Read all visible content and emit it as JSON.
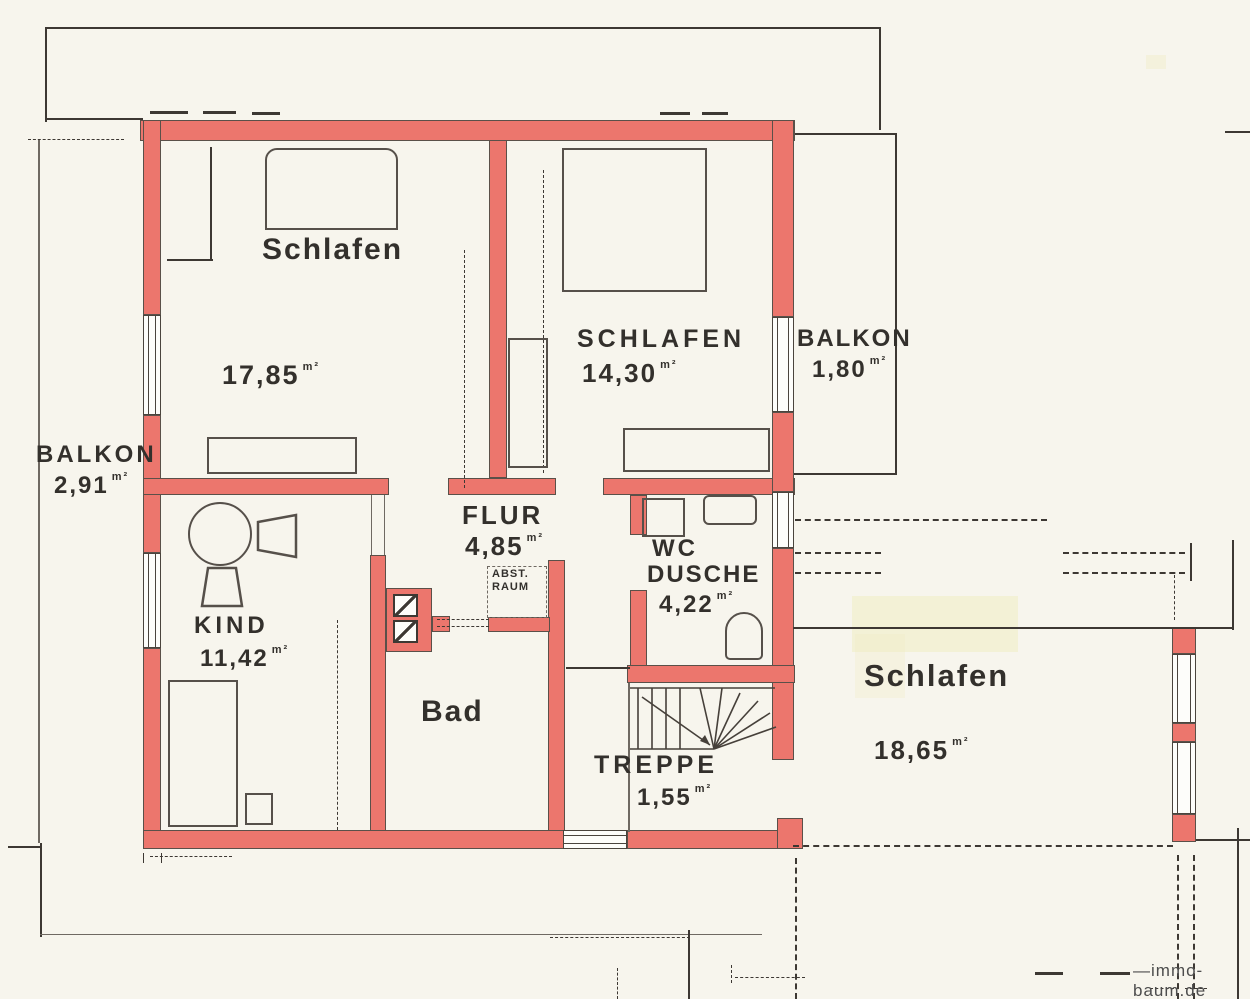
{
  "colors": {
    "paper": "#f7f5ed",
    "wall": "#ec766d",
    "wallEdge": "#5a5049",
    "line": "#3d3833",
    "lineLight": "#6f6962",
    "highlight": "#f1ecc3",
    "text": "#33302c",
    "watermark": "#4d4d4d"
  },
  "rooms": {
    "schlafen1": {
      "label": "Schlafen",
      "area": "17,85",
      "unit": "m²"
    },
    "schlafen2": {
      "label": "SCHLAFEN",
      "area": "14,30",
      "unit": "m²"
    },
    "balkon_right": {
      "label": "BALKON",
      "area": "1,80",
      "unit": "m²"
    },
    "balkon_left": {
      "label": "BALKON",
      "area": "2,91",
      "unit": "m²"
    },
    "kind": {
      "label": "KIND",
      "area": "11,42",
      "unit": "m²"
    },
    "flur": {
      "label": "FLUR",
      "area": "4,85",
      "unit": "m²"
    },
    "abstellraum": {
      "label_line1": "ABST.",
      "label_line2": "RAUM"
    },
    "bad": {
      "label": "Bad"
    },
    "wc_dusche": {
      "label_line1": "WC",
      "label_line2": "DUSCHE",
      "area": "4,22",
      "unit": "m²"
    },
    "treppe": {
      "label": "TREPPE",
      "area": "1,55",
      "unit": "m²"
    },
    "schlafen3": {
      "label": "Schlafen",
      "area": "18,65",
      "unit": "m²"
    }
  },
  "watermark": {
    "text": "immo-baum.de"
  }
}
